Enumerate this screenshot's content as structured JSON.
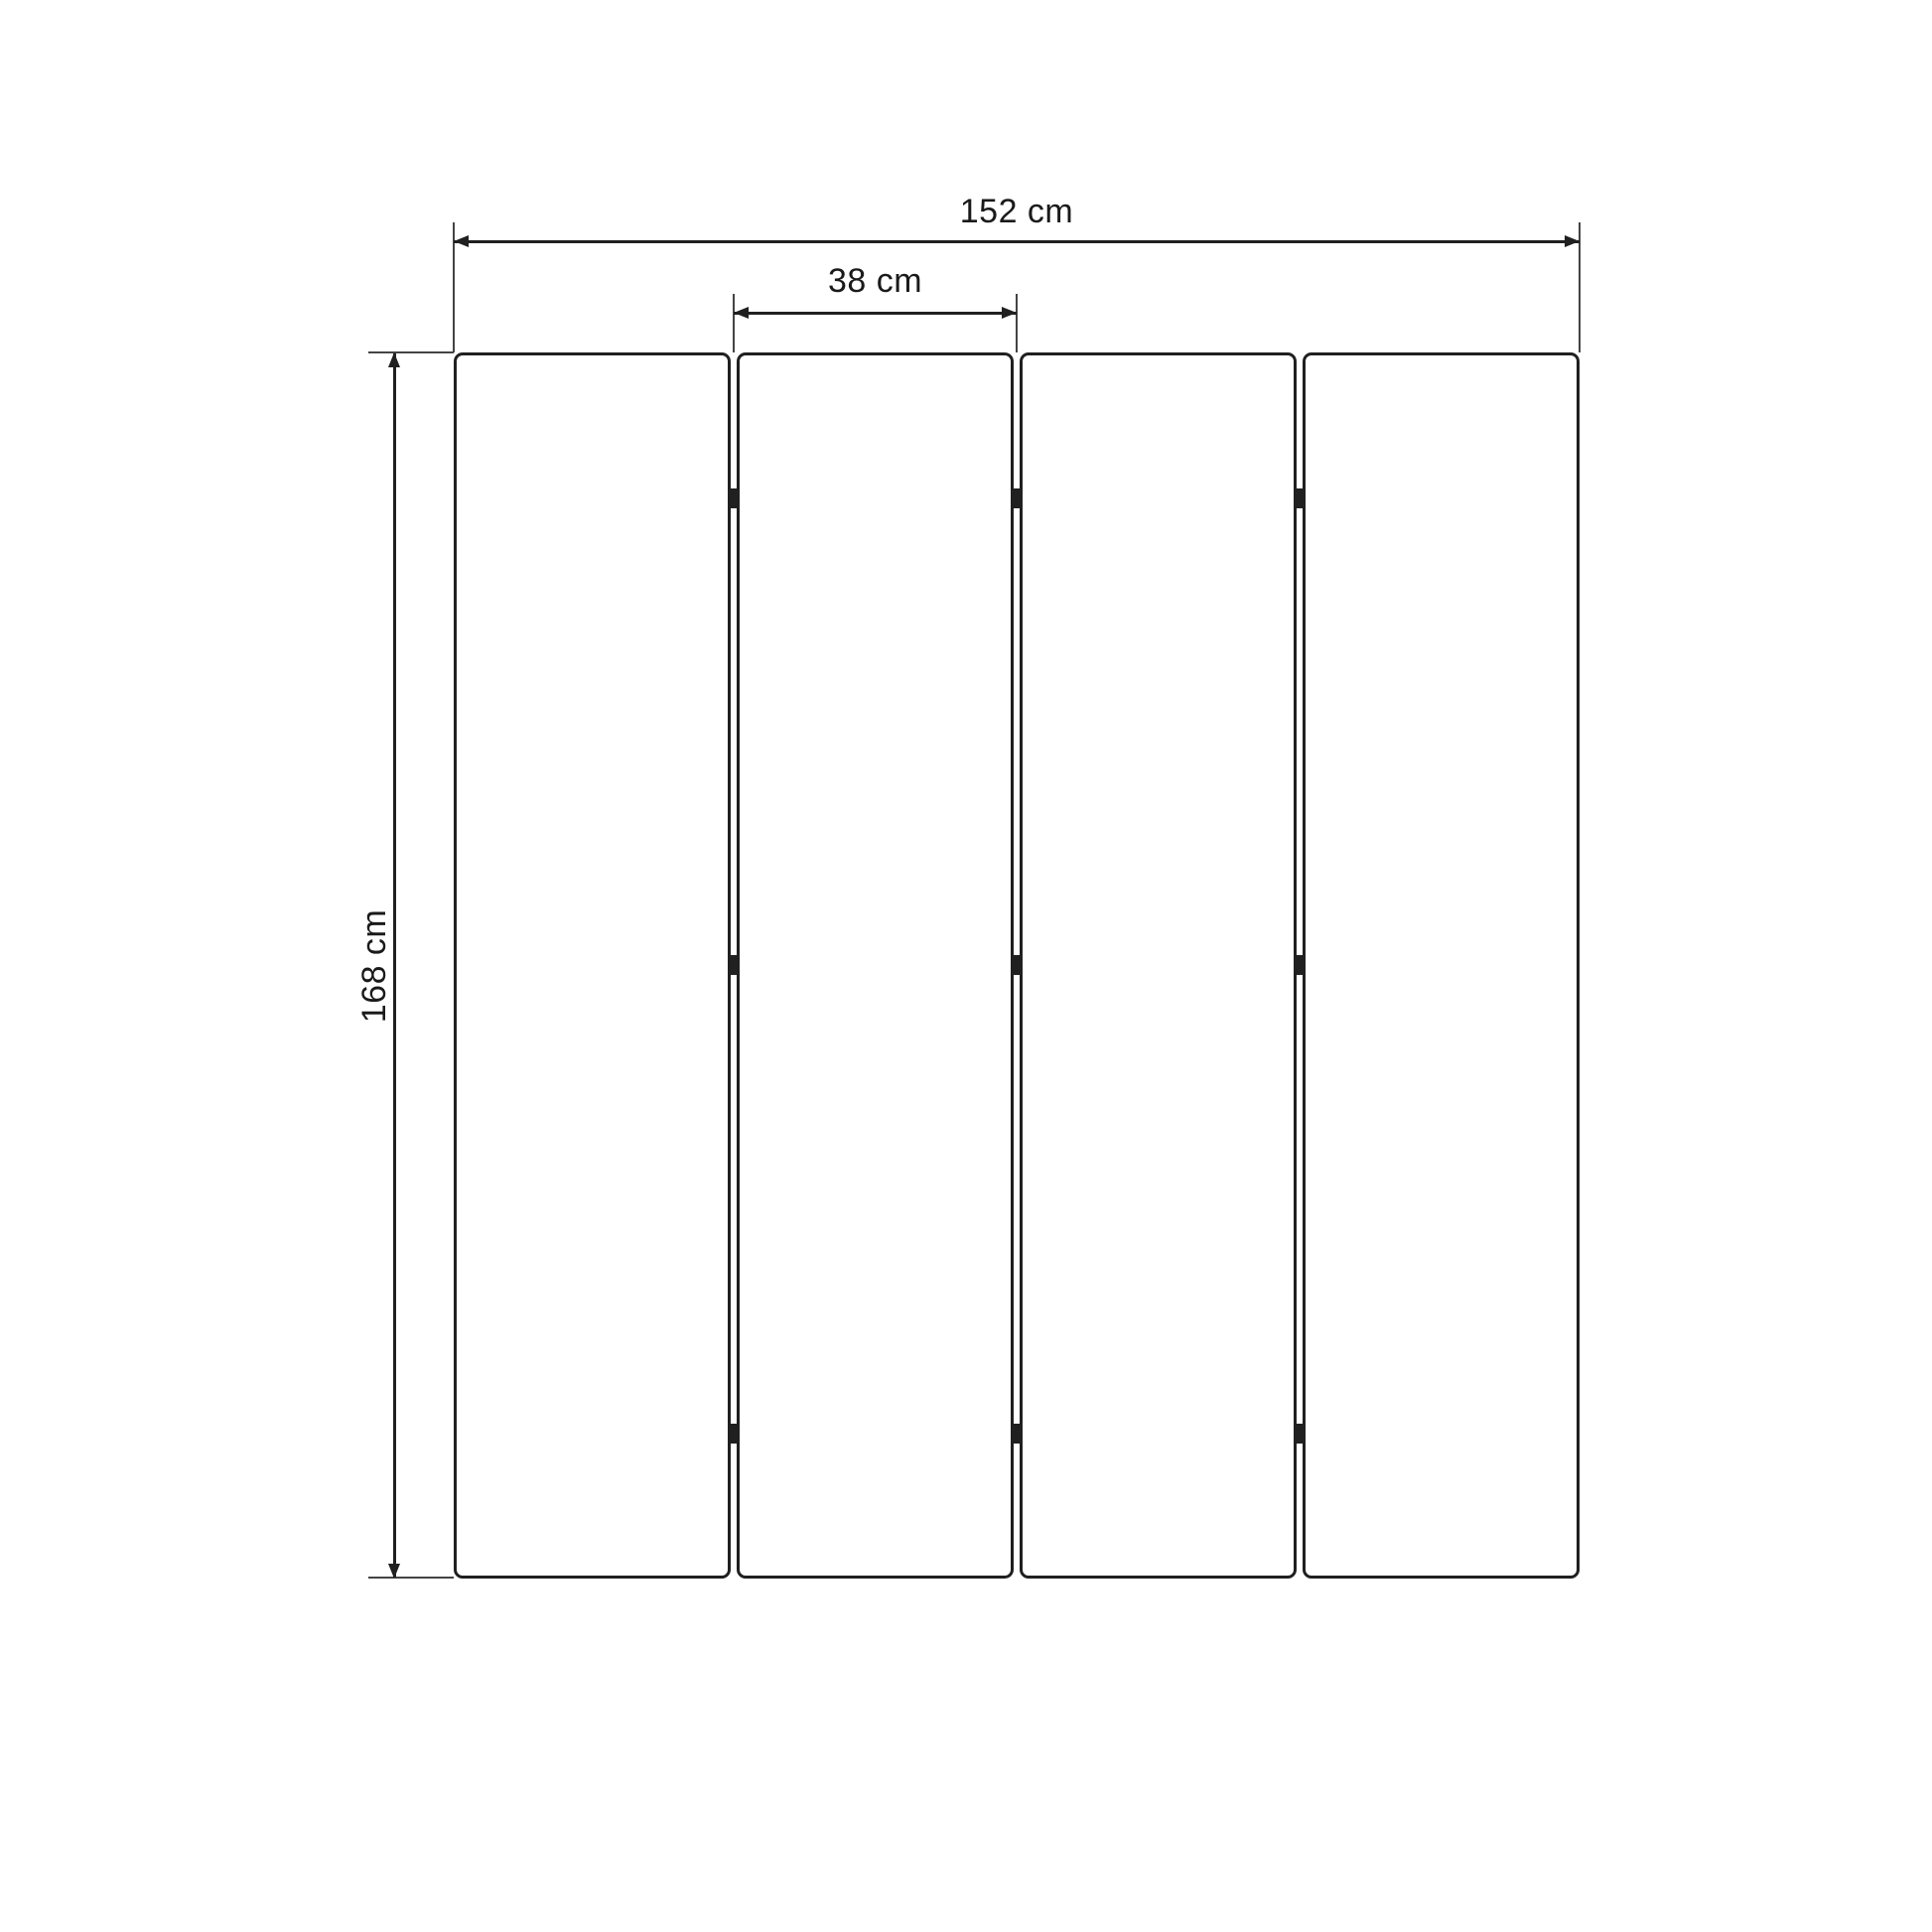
{
  "diagram": {
    "subject": "four-panel-room-divider-dimension-drawing",
    "view": "front-elevation",
    "background_color": "#ffffff",
    "line_color": "#202020",
    "extension_line_color": "#444444",
    "text_color": "#1a1a1a",
    "panel_count": 4,
    "hinge_marks_per_gap": 3,
    "dimensions": {
      "total_width": {
        "label": "152 cm",
        "orientation": "horizontal"
      },
      "panel_width": {
        "label": "38 cm",
        "orientation": "horizontal"
      },
      "height": {
        "label": "168 cm",
        "orientation": "vertical"
      }
    }
  }
}
